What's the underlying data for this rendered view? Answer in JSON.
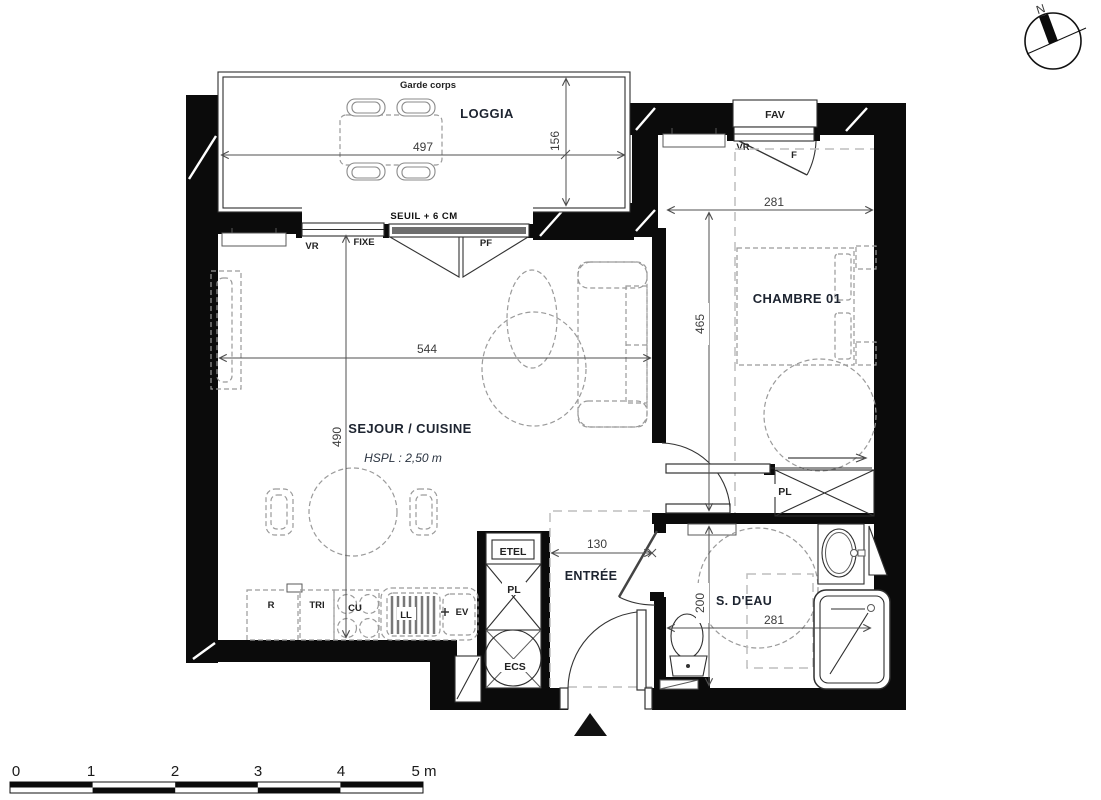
{
  "compass": {
    "north": "N"
  },
  "loggia": {
    "name": "LOGGIA",
    "garde_corps": "Garde corps",
    "width_cm": "497",
    "depth_cm": "156",
    "seuil": "SEUIL + 6 CM",
    "window_vr": "VR",
    "window_fixe": "FIXE",
    "window_pf": "PF"
  },
  "sejour": {
    "name": "SEJOUR / CUISINE",
    "hspl": "HSPL : 2,50 m",
    "width_cm": "544",
    "depth_cm": "490"
  },
  "kitchen": {
    "fridge": "R",
    "tri": "TRI",
    "hob": "CU",
    "washer": "LL",
    "sink": "EV"
  },
  "chambre": {
    "name": "CHAMBRE 01",
    "width_cm": "281",
    "depth_cm": "465",
    "closet": "PL",
    "window_fav": "FAV",
    "window_vr": "VR",
    "window_f": "F"
  },
  "entree": {
    "name": "ENTRÉE",
    "width_cm": "130",
    "etel": "ETEL",
    "closet": "PL",
    "water_heater": "ECS"
  },
  "sdeau": {
    "name": "S. D'EAU",
    "width_cm": "281",
    "depth_cm": "200"
  },
  "scale_bar": {
    "labels": [
      "0",
      "1",
      "2",
      "3",
      "4",
      "5 m"
    ]
  }
}
